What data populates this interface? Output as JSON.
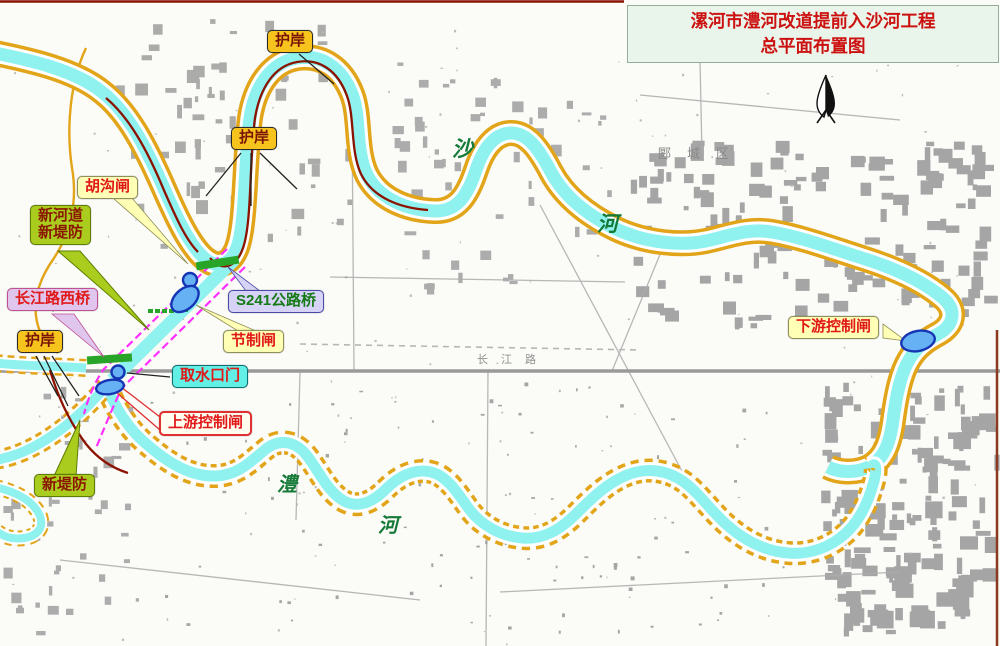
{
  "title": {
    "line1": "漯河市澧河改道提前入沙河工程",
    "line2": "总平面布置图"
  },
  "callouts": {
    "hugou_gate": "胡沟闸",
    "new_channel_dike": {
      "line1": "新河道",
      "line2": "新堤防"
    },
    "changjiang_rd_west_bridge": "长江路西桥",
    "revetment_left": "护岸",
    "revetment_top": "护岸",
    "revetment_mid": "护岸",
    "s241_highway_bridge": "S241公路桥",
    "regulating_gate": "节制闸",
    "water_intake_gate": "取水口门",
    "upstream_control_gate": "上游控制闸",
    "new_dike": "新堤防",
    "downstream_control_gate": "下游控制闸"
  },
  "map_texts": {
    "sha_char": "沙",
    "sha_he_char": "河",
    "li_char": "澧",
    "li_he_char": "河",
    "district": "郾城区",
    "changjiang_road": "长江路"
  },
  "legend_colors": {
    "river_water": "#8ff2ef",
    "dike_line": "#e2a51a",
    "revetment_line": "#8b1200",
    "new_dike_line": "#ff30ff",
    "guard_bar_green": "#28a428",
    "gate_fill": "#66b0f4",
    "gate_border": "#1535b5",
    "title_text": "#cc1111",
    "title_bg": "#e9f5ea"
  }
}
